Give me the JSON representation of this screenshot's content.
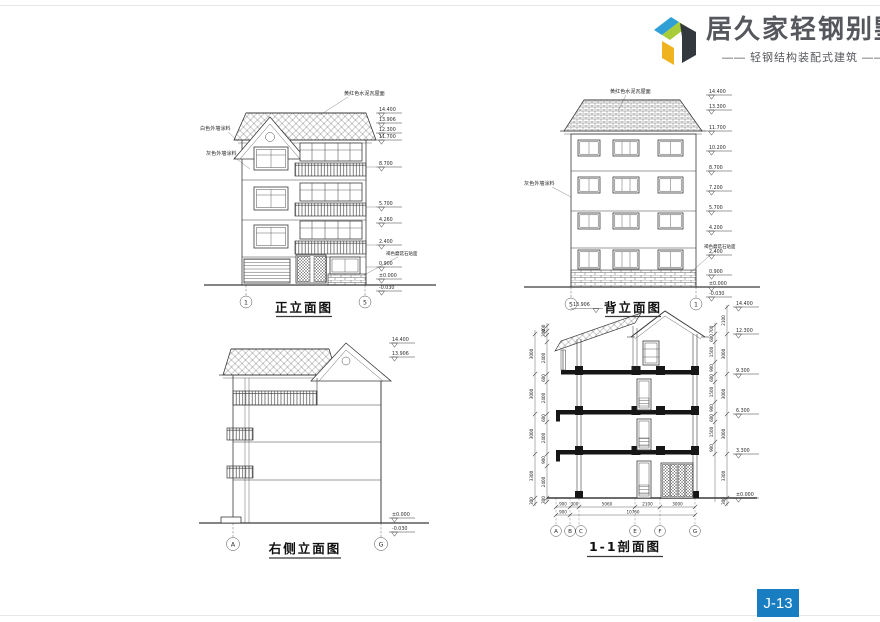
{
  "header": {
    "title": "居久家轻钢别墅",
    "subtitle": "—— 轻钢结构装配式建筑 ——",
    "text_color": "#55575c",
    "logo_colors": {
      "blue": "#2f9fd6",
      "green": "#a8cc3a",
      "dark": "#33383f",
      "yellow": "#efb31f"
    }
  },
  "footer": {
    "page_number": "J-13",
    "badge_color": "#187dc1"
  },
  "drawings": {
    "front": {
      "title": "正立面图",
      "roof_label": "黄红色水泥瓦屋面",
      "wall_label_white": "白色外墙涂料",
      "wall_label_gray": "灰色外墙涂料",
      "stone_label": "褐色蘑菇石贴面",
      "marks": [
        "14.400",
        "13.906",
        "12.300",
        "11.700",
        "8.700",
        "5.700",
        "4.260",
        "2.400",
        "0.900",
        "±0.000",
        "-0.030"
      ],
      "axes": [
        "1",
        "5"
      ]
    },
    "back": {
      "title": "背立面图",
      "roof_label": "黄红色水泥瓦屋面",
      "wall_label_gray": "灰色外墙涂料",
      "stone_label": "褐色蘑菇石贴面",
      "marks": [
        "14.400",
        "13.300",
        "11.700",
        "10.200",
        "8.700",
        "7.200",
        "5.700",
        "4.200",
        "2.400",
        "0.900",
        "±0.000",
        "-0.030"
      ],
      "axes": [
        "5",
        "1"
      ]
    },
    "side": {
      "title": "右侧立面图",
      "marks_top": [
        "14.400",
        "13.906"
      ],
      "marks_bottom": [
        "±0.000",
        "-0.030"
      ],
      "axes": [
        "A",
        "G"
      ]
    },
    "section": {
      "title": "1-1剖面图",
      "ridge_mark": "13.906",
      "marks_right": [
        "14.400",
        "12.300",
        "9.300",
        "6.300",
        "3.300",
        "±0.000"
      ],
      "dims_left_outer": [
        "3000",
        "3000",
        "3000",
        "3300",
        "300"
      ],
      "dims_left_inner": [
        "400",
        "300",
        "2400",
        "600",
        "2400",
        "600",
        "2400",
        "900",
        "2400",
        "300"
      ],
      "dims_right_outer": [
        "2100",
        "3000",
        "3000",
        "3000",
        "3300",
        "300"
      ],
      "dims_right_inner": [
        "700",
        "600",
        "1500",
        "900",
        "600",
        "1500",
        "900",
        "600",
        "1500",
        "900"
      ],
      "dims_bottom_row1": [
        "900",
        "300",
        "5060",
        "2100",
        "3000"
      ],
      "dims_bottom_row2_left": "900",
      "dims_bottom_total": "10760",
      "axes": [
        "A",
        "B",
        "C",
        "E",
        "F",
        "G"
      ]
    }
  }
}
